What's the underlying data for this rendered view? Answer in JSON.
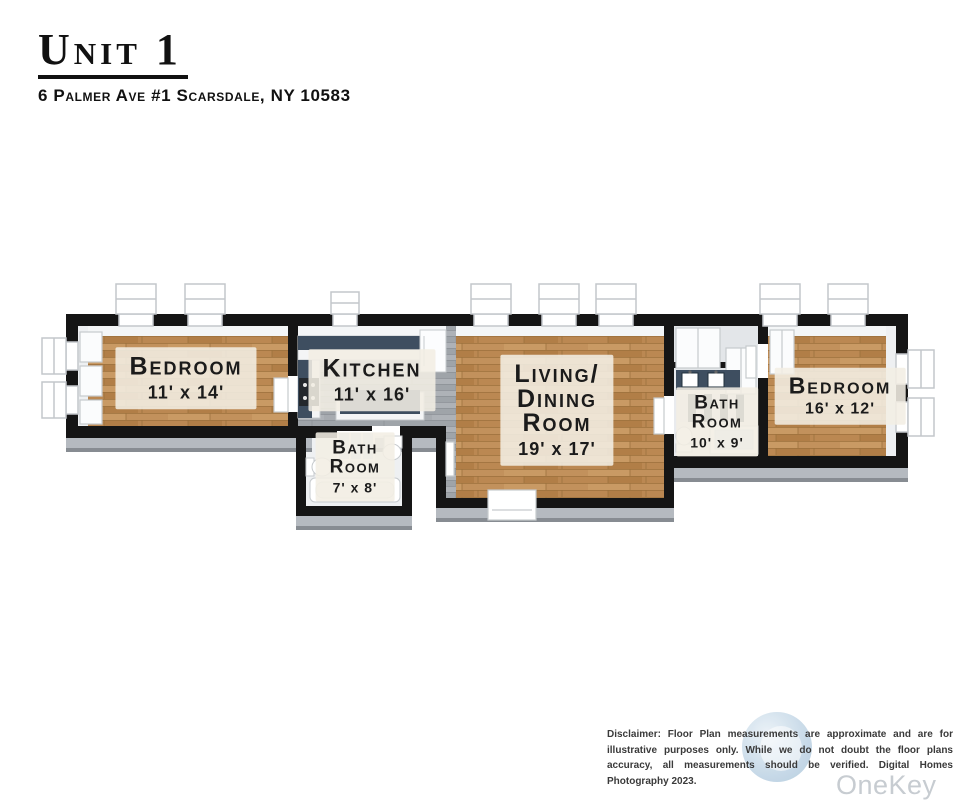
{
  "header": {
    "title": "Unit 1",
    "address": "6 Palmer Ave #1 Scarsdale, NY 10583"
  },
  "rooms": {
    "bedroom1": {
      "line1": "Bedroom",
      "dims": "11' x 14'"
    },
    "kitchen": {
      "line1": "Kitchen",
      "dims": "11' x 16'"
    },
    "bath1": {
      "line1": "Bath",
      "line2": "Room",
      "dims": "7' x 8'"
    },
    "living": {
      "line1": "Living/",
      "line2": "Dining",
      "line3": "Room",
      "dims": "19' x 17'"
    },
    "bath2": {
      "line1": "Bath",
      "line2": "Room",
      "dims": "10' x 9'"
    },
    "bedroom2": {
      "line1": "Bedroom",
      "dims": "16' x 12'"
    }
  },
  "footer": {
    "disclaimer": "Disclaimer: Floor Plan measurements are approximate and are for illustrative purposes only. While we do not doubt the floor plans accuracy, all measurements should be verified. Digital Homes Photography 2023.",
    "watermark": "OneKey MLS"
  },
  "colors": {
    "wall": "#151515",
    "wood_floor": "#c2915c",
    "gray_floor": "#a7abb0",
    "counter": "#3e4e60",
    "label_bg": "rgba(242,238,228,0.88)",
    "extrusion": "#b5bac0",
    "watermark_blue": "#c2d6e6",
    "watermark_text": "#c7ccd1"
  }
}
